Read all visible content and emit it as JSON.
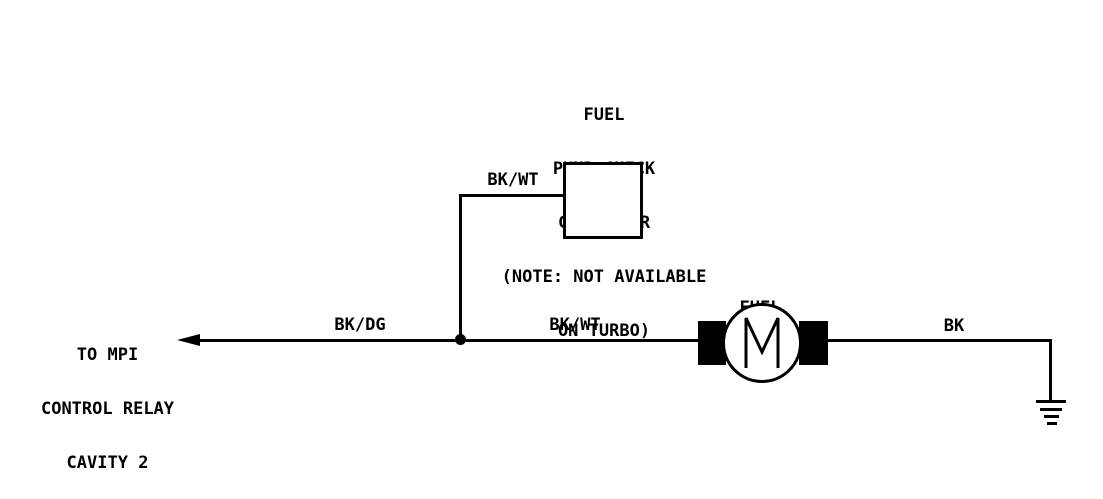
{
  "diagram": {
    "background_color": "#ffffff",
    "line_color": "#000000",
    "check_connector": {
      "label_lines": [
        "FUEL",
        "PUMP CHECK",
        "CONNECTOR",
        "(NOTE: NOT AVAILABLE",
        "ON TURBO)"
      ]
    },
    "mpi_relay": {
      "label_lines": [
        "TO MPI",
        "CONTROL RELAY",
        "CAVITY 2"
      ]
    },
    "fuel_pump": {
      "label_lines": [
        "FUEL",
        "PUMP"
      ],
      "motor_letter": "M"
    },
    "wire_labels": {
      "check_connector_wire": "BK/WT",
      "relay_wire": "BK/DG",
      "pump_wire": "BK/WT",
      "ground_wire": "BK"
    }
  }
}
